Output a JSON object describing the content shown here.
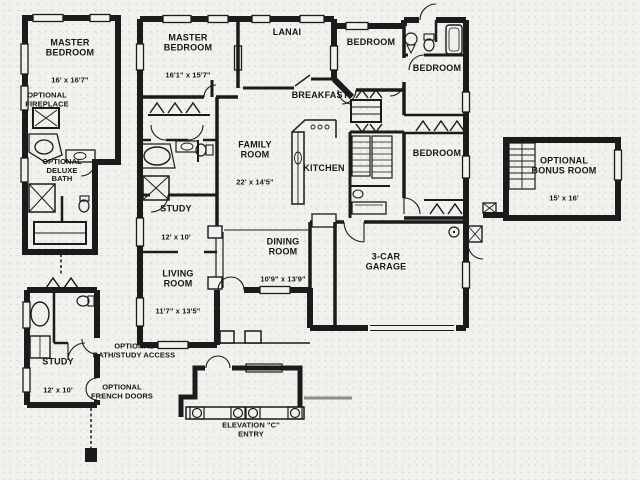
{
  "figure": {
    "kind": "floor-plan",
    "colors": {
      "ink": "#1b1b1b",
      "paper": "#f2f1ed"
    }
  },
  "rooms": [
    {
      "id": "master-bedroom-optional",
      "name": "MASTER\nBEDROOM",
      "dims": "16' x 16'7\""
    },
    {
      "id": "master-bedroom",
      "name": "MASTER\nBEDROOM",
      "dims": "16'1\" x 15'7\""
    },
    {
      "id": "lanai",
      "name": "LANAI",
      "dims": ""
    },
    {
      "id": "bedroom-top",
      "name": "BEDROOM",
      "dims": ""
    },
    {
      "id": "bedroom-upper-right",
      "name": "BEDROOM",
      "dims": ""
    },
    {
      "id": "bedroom-lower-right",
      "name": "BEDROOM",
      "dims": ""
    },
    {
      "id": "breakfast",
      "name": "BREAKFAST",
      "dims": ""
    },
    {
      "id": "family-room",
      "name": "FAMILY\nROOM",
      "dims": "22' x 14'5\""
    },
    {
      "id": "kitchen",
      "name": "KITCHEN",
      "dims": ""
    },
    {
      "id": "study",
      "name": "STUDY",
      "dims": "12' x 10'"
    },
    {
      "id": "dining-room",
      "name": "DINING\nROOM",
      "dims": "10'9\" x 13'9\""
    },
    {
      "id": "living-room",
      "name": "LIVING\nROOM",
      "dims": "11'7\" x 13'5\""
    },
    {
      "id": "garage",
      "name": "3-CAR\nGARAGE",
      "dims": ""
    },
    {
      "id": "bonus-room",
      "name": "OPTIONAL\nBONUS ROOM",
      "dims": "15' x 16'"
    },
    {
      "id": "study-optional",
      "name": "STUDY",
      "dims": "12' x 10'"
    }
  ],
  "annotations": [
    {
      "id": "optional-fireplace",
      "text": "OPTIONAL\nFIREPLACE"
    },
    {
      "id": "optional-deluxe-bath",
      "text": "OPTIONAL\nDELUXE\nBATH"
    },
    {
      "id": "optional-bath-study-access",
      "text": "OPTIONAL\nBATH/STUDY ACCESS"
    },
    {
      "id": "optional-french-doors",
      "text": "OPTIONAL\nFRENCH DOORS"
    },
    {
      "id": "elevation-entry",
      "text": "ELEVATION \"C\"\nENTRY"
    }
  ]
}
